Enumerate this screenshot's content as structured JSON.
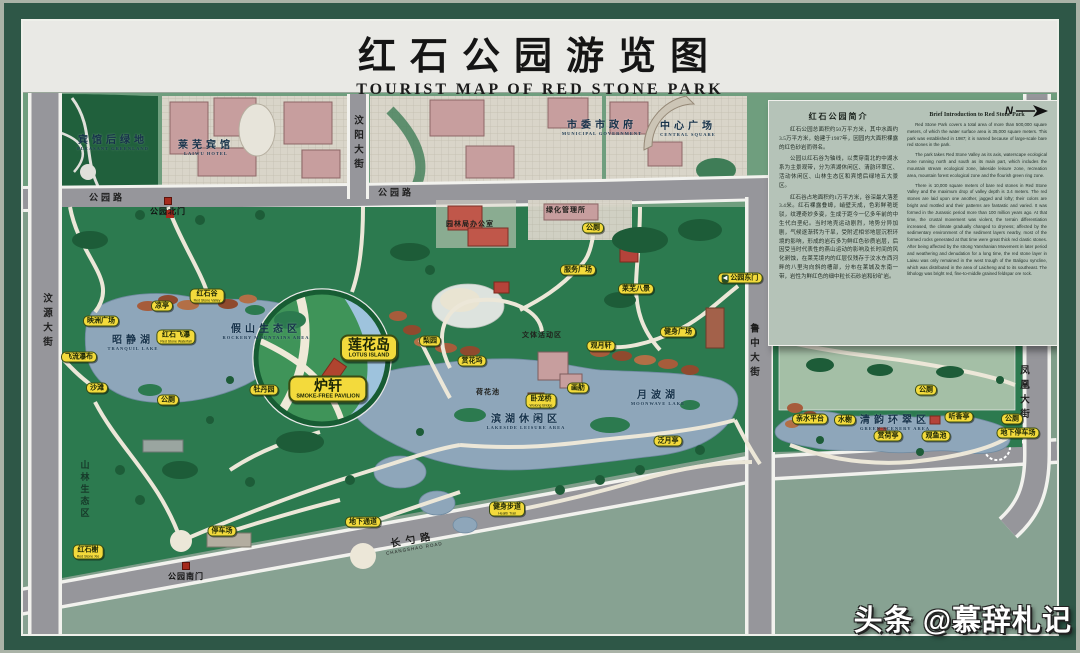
{
  "title": {
    "cn": "红石公园游览图",
    "en": "TOURIST MAP OF RED STONE PARK"
  },
  "watermark": {
    "brand": "头条",
    "account": "@慕辞札记"
  },
  "info_panel": {
    "cn_title": "红石公园简介",
    "cn_paragraphs": [
      "红石公园总面积约50万平方米，其中水面约3.5万平方米，始建于1987年，因园内大面积裸露的红色砂岩而得名。",
      "公园以红石谷为轴线，以贯穿南北的中湖水系为主景观带，分为滨湖休闲区、清韵环翠区、活动休闲区、山林生态区和宾馆后绿地五大景区。",
      "红石谷占地面积约1万平方米，谷深最大落差3.4米。红石裸露叠嶂，峭壁天成，色彩鲜艳斑驳，纹理奇妙多姿，生成于距今一亿多年前的中生代白垩纪。当时地壳运动剧烈，地势分异加剧，气候逐渐转为干旱，受附近相邻地层沉积环境的影响，形成的岩石多为鲜红色砂质岩层，后因受当时代表性的燕山运动的影响及长时间的风化剥蚀，在莱芜境内的红层仅残存于汶水东西河畔的八里沟向斜的槽部，分布在莱城及东南一带，岩性为鲜红色的细中粒长石砂岩和砂矿岩。"
    ],
    "en_title": "Brief Introduction to Red Stone Park",
    "en_paragraphs": [
      "Red Stone Park covers a total area of more than 500,000 square meters, of which the water surface area is 35,000 square meters. This park was established in 1987; it is named because of large-scale bare red stones in the park.",
      "The park takes Red Stone Valley as its axis, waterscape ecological zone running north and south as its main part, which includes the mountain stream ecological zone, lakeside leisure zone, recreation area, mountain forest ecological zone and the flourish green ring zone.",
      "There is 10,000 square meters of bare red stones in Red Stone Valley and the maximum drop of valley depth is 3.4 meters. The red stones are laid upon one another, jagged and lofty; their colors are bright and mottled and their patterns are fantastic and varied. It was formed in the Jurassic period more than 100 million years ago. At that time, the crustal movement was violent, the terrain differentiation increased, the climate gradually changed to dryness; affected by the sedimentary environment of the sediment layers nearby, most of the formed rocks generated at that time were great thick red clastic stones. After being affected by the strong Yanshanian Movement in later period and weathering and denudation for a long time, the red stone layer in Laiwu was only remained in the west trough of the Baligou syncline, which was distributed in the area of Laicheng and to its southeast. The lithology was bright red, fine-to-middle grained feldspar ore rock."
    ],
    "compass_label": "N"
  },
  "colors": {
    "frame_green": "#2e5747",
    "park_green": "#2c7a4f",
    "water_blue": "#8ea6ba",
    "badge_yellow": "#f3da3c",
    "road_gray": "#96969b",
    "panel_sage": "#b5c3b8",
    "building_pink": "#c79e9e",
    "red_stone": "#a65c3b"
  },
  "map": {
    "labels": [
      {
        "name": "street-wenyuan-avenue",
        "kind": "street-v",
        "text": "汶源大街",
        "x": 46,
        "y": 322
      },
      {
        "name": "street-wenyang-avenue",
        "kind": "street-v",
        "text": "汶阳大街",
        "x": 357,
        "y": 144
      },
      {
        "name": "street-luzhong-avenue",
        "kind": "street-v",
        "text": "鲁中大街",
        "x": 753,
        "y": 352
      },
      {
        "name": "street-fenghuang-avenue",
        "kind": "street-v",
        "text": "凤凰大街",
        "x": 1023,
        "y": 394
      },
      {
        "name": "street-gongyuan-road-west",
        "kind": "street-h",
        "text": "公园路",
        "x": 107,
        "y": 197
      },
      {
        "name": "street-gongyuan-road-mid",
        "kind": "street-h",
        "text": "公园路",
        "x": 396,
        "y": 192
      },
      {
        "name": "street-changshao-road",
        "kind": "street-d",
        "text": "长勺路",
        "en": "CHANGSHAO ROAD",
        "x": 413,
        "y": 541,
        "rot": -10
      },
      {
        "name": "area-hotel-greenland",
        "kind": "area",
        "text": "宾馆后绿地",
        "en": "PLEASANT GREENLAND",
        "x": 113,
        "y": 141
      },
      {
        "name": "area-laiwu-hotel",
        "kind": "area",
        "text": "莱芜宾馆",
        "en": "LAIWU HOTEL",
        "x": 206,
        "y": 146
      },
      {
        "name": "area-municipal-government",
        "kind": "area",
        "text": "市委市政府",
        "en": "MUNICIPAL GOVERNMENT",
        "x": 602,
        "y": 126
      },
      {
        "name": "area-central-square",
        "kind": "area",
        "text": "中心广场",
        "en": "CENTRAL SQUARE",
        "x": 688,
        "y": 127
      },
      {
        "name": "area-greening-office",
        "kind": "area-sm",
        "text": "绿化管理所",
        "x": 566,
        "y": 210
      },
      {
        "name": "area-garden-bureau-office",
        "kind": "area-sm",
        "text": "园林局办公室",
        "x": 470,
        "y": 224
      },
      {
        "name": "area-zhaojing-lake",
        "kind": "area",
        "text": "昭静湖",
        "en": "TRANQUIL LAKE",
        "x": 133,
        "y": 341
      },
      {
        "name": "area-rockery-mountains",
        "kind": "area",
        "text": "假山生态区",
        "en": "ROCKERY MOUNTAINS AREA",
        "x": 266,
        "y": 330
      },
      {
        "name": "area-sports-leisure",
        "kind": "area-sm",
        "text": "文体活动区",
        "x": 542,
        "y": 335
      },
      {
        "name": "area-lotus-pond",
        "kind": "area-sm",
        "text": "荷花池",
        "x": 488,
        "y": 392
      },
      {
        "name": "area-moonwave-lake",
        "kind": "area",
        "text": "月波湖",
        "en": "MOONWAVE LAKE",
        "x": 658,
        "y": 396
      },
      {
        "name": "area-lakeside-leisure",
        "kind": "area",
        "text": "滨湖休闲区",
        "en": "LAKESIDE LEISURE AREA",
        "x": 526,
        "y": 420
      },
      {
        "name": "area-qingyun-green",
        "kind": "area",
        "text": "清韵环翠区",
        "en": "GREEN SCENERY AREA",
        "x": 895,
        "y": 421
      },
      {
        "name": "area-mountain-forest",
        "kind": "area-v",
        "text": "山林生态区",
        "x": 85,
        "y": 490
      },
      {
        "name": "gate-north",
        "kind": "gate",
        "text": "公园北门",
        "x": 168,
        "y": 207
      },
      {
        "name": "gate-south",
        "kind": "gate",
        "text": "公园南门",
        "x": 186,
        "y": 572
      },
      {
        "name": "badge-red-stone-valley",
        "kind": "badge",
        "text": "红石谷",
        "en": "Red Stone Valley",
        "x": 207,
        "y": 296
      },
      {
        "name": "badge-pavilion",
        "kind": "badge",
        "text": "凉亭",
        "x": 162,
        "y": 306
      },
      {
        "name": "badge-yingzhou-square",
        "kind": "badge",
        "text": "映洲广场",
        "x": 101,
        "y": 321
      },
      {
        "name": "badge-red-stone-waterfall",
        "kind": "badge",
        "text": "红石飞瀑",
        "en": "Red Stone Waterfall",
        "x": 176,
        "y": 337
      },
      {
        "name": "badge-flying-waterfall",
        "kind": "badge",
        "text": "飞流瀑布",
        "x": 79,
        "y": 357
      },
      {
        "name": "badge-beach",
        "kind": "badge",
        "text": "沙滩",
        "x": 97,
        "y": 388
      },
      {
        "name": "badge-toilet-west",
        "kind": "badge",
        "text": "公厕",
        "x": 168,
        "y": 400
      },
      {
        "name": "badge-peony-garden",
        "kind": "badge",
        "text": "牡丹园",
        "x": 264,
        "y": 390
      },
      {
        "name": "badge-pear-garden",
        "kind": "badge",
        "text": "梨园",
        "x": 430,
        "y": 341
      },
      {
        "name": "badge-flower-dock",
        "kind": "badge",
        "text": "赏花坞",
        "x": 472,
        "y": 361
      },
      {
        "name": "badge-moon-pavilion",
        "kind": "badge",
        "text": "观月轩",
        "x": 601,
        "y": 346
      },
      {
        "name": "badge-pleasure-boat",
        "kind": "badge",
        "text": "画舫",
        "x": 578,
        "y": 388
      },
      {
        "name": "badge-wolong-bridge",
        "kind": "badge",
        "text": "卧龙桥",
        "en": "Wolong Bridge",
        "x": 541,
        "y": 401
      },
      {
        "name": "badge-fanyue-pavilion",
        "kind": "badge",
        "text": "泛月亭",
        "x": 668,
        "y": 441
      },
      {
        "name": "badge-toilet-north",
        "kind": "badge",
        "text": "公厕",
        "x": 593,
        "y": 228
      },
      {
        "name": "badge-service-square",
        "kind": "badge",
        "text": "服务广场",
        "x": 578,
        "y": 270
      },
      {
        "name": "badge-laiwu-eight-scenes",
        "kind": "badge",
        "text": "莱芜八景",
        "x": 636,
        "y": 289
      },
      {
        "name": "badge-east-gate",
        "kind": "badge",
        "text": "公园东门",
        "x": 740,
        "y": 278,
        "arrow": true
      },
      {
        "name": "badge-fitness-square",
        "kind": "badge",
        "text": "健身广场",
        "x": 678,
        "y": 332
      },
      {
        "name": "badge-rockery-green",
        "kind": "badge",
        "text": "假山叠翠",
        "x": 793,
        "y": 333
      },
      {
        "name": "badge-toilet-east",
        "kind": "badge",
        "text": "公厕",
        "x": 926,
        "y": 390
      },
      {
        "name": "badge-tingxiang-pavilion",
        "kind": "badge",
        "text": "听香亭",
        "x": 959,
        "y": 417
      },
      {
        "name": "badge-waterfront-platform",
        "kind": "badge",
        "text": "亲水平台",
        "x": 810,
        "y": 419
      },
      {
        "name": "badge-waterside-pavilion",
        "kind": "badge",
        "text": "水榭",
        "x": 845,
        "y": 420
      },
      {
        "name": "badge-lotus-viewing-pavilion",
        "kind": "badge",
        "text": "赏荷亭",
        "x": 888,
        "y": 436
      },
      {
        "name": "badge-fish-pond",
        "kind": "badge",
        "text": "观鱼池",
        "x": 936,
        "y": 436
      },
      {
        "name": "badge-toilet-southeast",
        "kind": "badge",
        "text": "公厕",
        "x": 1012,
        "y": 419
      },
      {
        "name": "badge-underground-parking",
        "kind": "badge",
        "text": "地下停车场",
        "x": 1018,
        "y": 433
      },
      {
        "name": "badge-red-stone-xie",
        "kind": "badge",
        "text": "红石榭",
        "en": "Red Stone Xie",
        "x": 88,
        "y": 552
      },
      {
        "name": "badge-parking-lot",
        "kind": "badge",
        "text": "停车场",
        "x": 222,
        "y": 531
      },
      {
        "name": "badge-underpass",
        "kind": "badge",
        "text": "地下通道",
        "x": 363,
        "y": 522
      },
      {
        "name": "badge-health-trail",
        "kind": "badge",
        "text": "健身步道",
        "en": "Health Trail",
        "x": 507,
        "y": 509
      },
      {
        "name": "badge-smoke-free-pavilion",
        "kind": "badge-lg",
        "text": "炉轩",
        "en": "SMOKE-FREE PAVILION",
        "x": 328,
        "y": 389
      },
      {
        "name": "badge-lotus-island",
        "kind": "badge-lg",
        "text": "莲花岛",
        "en": "LOTUS ISLAND",
        "x": 369,
        "y": 348
      }
    ]
  }
}
